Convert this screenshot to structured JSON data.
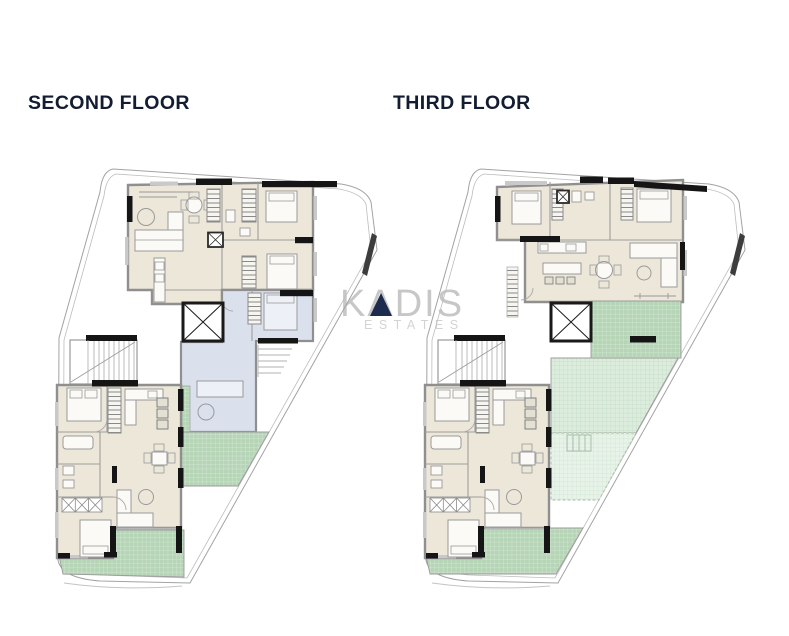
{
  "page": {
    "width": 789,
    "height": 636,
    "background": "#ffffff"
  },
  "plans": [
    {
      "id": "second",
      "title": "SECOND FLOOR"
    },
    {
      "id": "third",
      "title": "THIRD FLOOR"
    }
  ],
  "watermark": {
    "brand": "KADIS",
    "subtitle": "ESTATES"
  },
  "colors": {
    "title_text": "#131c31",
    "watermark_brand": "#c7c7c5",
    "watermark_subtitle": "#d3d3d0",
    "watermark_accent": "#1d2c4e",
    "apartment_fill": "#ece7d9",
    "secondary_unit_fill": "#dbe0ed",
    "terrace_green": "#b5d5b6",
    "terrace_green_light": "#dcecdd",
    "terrace_green_pale": "#e7f2e8",
    "wall_dark": "#151515",
    "wall_gray": "#8f8f8f",
    "boundary_gray": "#a3a3a3"
  }
}
